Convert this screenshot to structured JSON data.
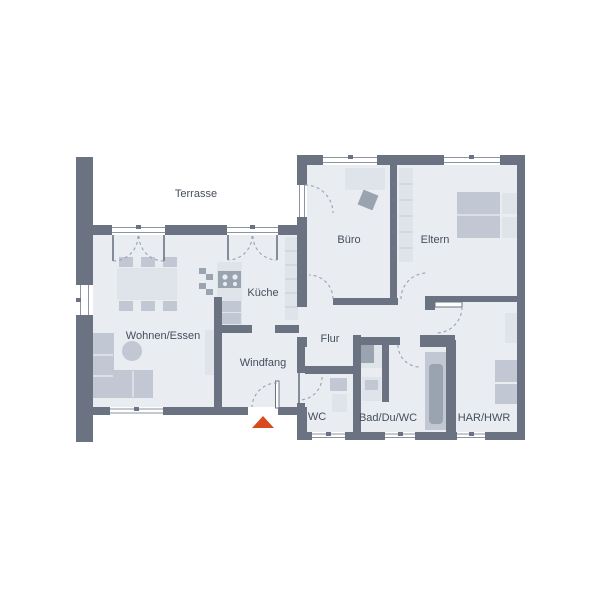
{
  "plan": {
    "title": "Bungalow floor plan",
    "labels": {
      "terrasse": "Terrasse",
      "buero": "Büro",
      "eltern": "Eltern",
      "kueche": "Küche",
      "wohnen_essen": "Wohnen/Essen",
      "windfang": "Windfang",
      "flur": "Flur",
      "wc": "WC",
      "bad": "Bad/Du/WC",
      "har": "HAR/HWR"
    },
    "colors": {
      "wall": "#6b7383",
      "floor": "#e9edf2",
      "furniture_light": "#dfe3ea",
      "furniture_mid": "#c2c8d3",
      "furniture_dark": "#9aa3b0",
      "divider": "#c6ccd6",
      "frame": "#8d95a2",
      "dash": "#9aa2ae",
      "text": "#454e5c",
      "marker": "#d94b1e",
      "window_fill": "#ffffff"
    },
    "entrance_marker": "triangle-up"
  }
}
